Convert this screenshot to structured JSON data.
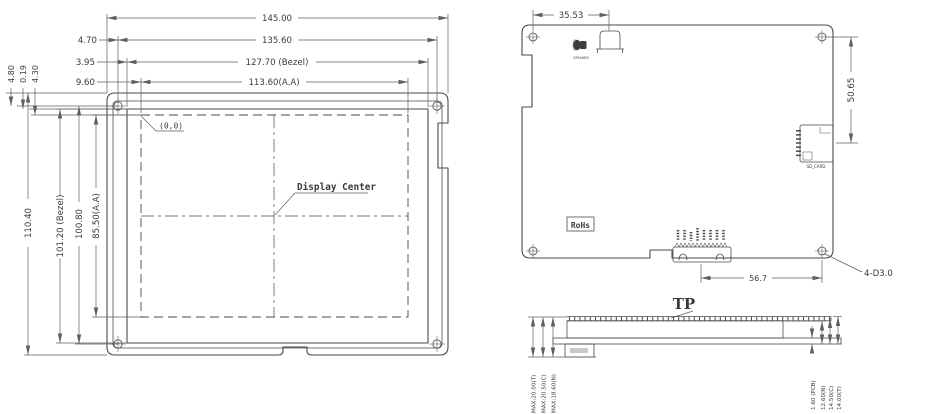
{
  "page": {
    "background": "#ffffff",
    "line_color": "#4a4a4a",
    "title": "LCD module outline drawing"
  },
  "front_view": {
    "dim_overall_width": "145.00",
    "dim_hole_span_width": "135.60",
    "dim_bezel_width": "127.70 (Bezel)",
    "dim_active_width": "113.60(A.A)",
    "offset_edge_to_hole": "4.70",
    "offset_hole_to_bezel": "3.95",
    "offset_hole_to_active": "9.60",
    "offset_top_a": "4.80",
    "offset_top_b": "0.19",
    "offset_top_c": "4.30",
    "dim_overall_height": "110.40",
    "dim_bezel_height": "101.20 (Bezel)",
    "dim_hole_span_height": "100.80",
    "dim_active_height": "85.50(A.A)",
    "origin_label": "(0,0)",
    "display_center_label": "Display Center"
  },
  "back_view": {
    "dim_buzzer_offset": "35.53",
    "dim_sd_offset": "50.65",
    "dim_connector_to_hole": "56.7",
    "mounting_holes_label": "4-D3.0",
    "rohs_label": "RoHs",
    "sd_card_label": "SD_CARD",
    "speaker_label": "SPEAKER"
  },
  "side_view": {
    "tp_label": "TP",
    "dims_left": [
      "MAX:20.00(T)",
      "MAX:20.50(C)",
      "MAX:18.60(N)"
    ],
    "dims_right": [
      "1.60 (PCB)",
      "12.60(N)",
      "14.50(C)",
      "14.00(T)"
    ]
  }
}
